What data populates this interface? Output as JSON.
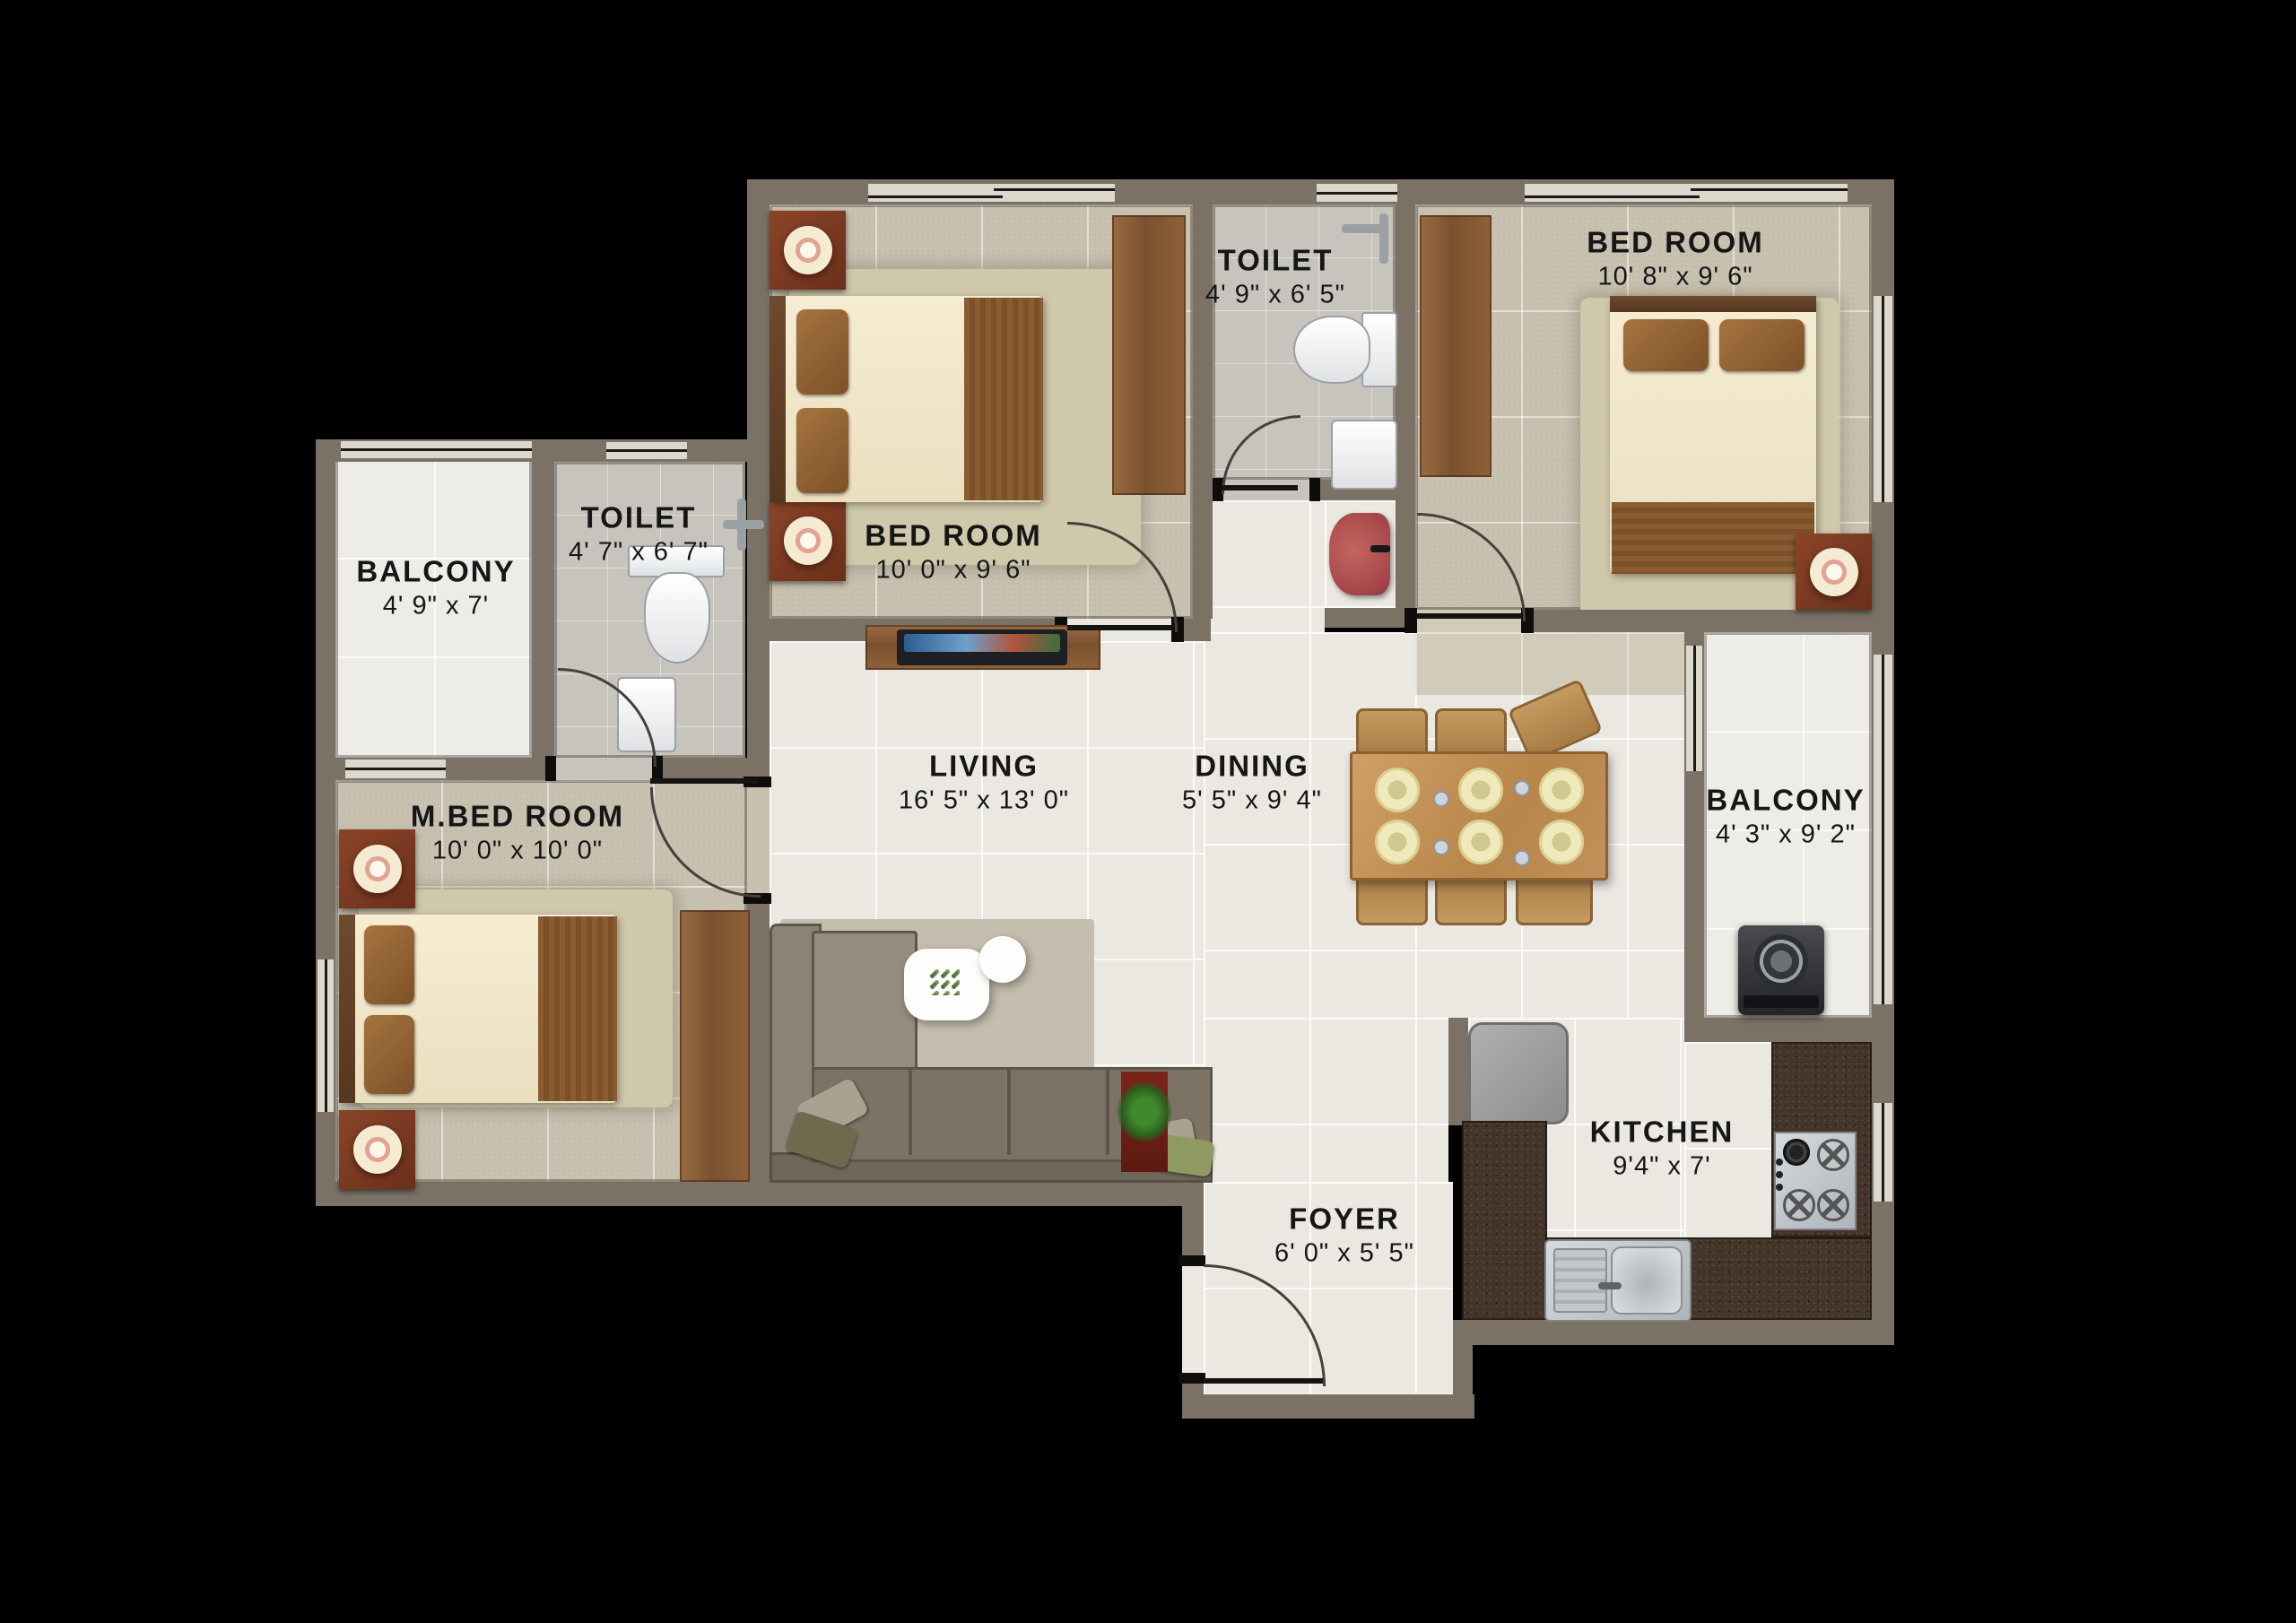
{
  "plan": {
    "background": "#000000",
    "wall_color": "#7b7265",
    "accent_colors": {
      "floor_beige": "#c8c1b0",
      "floor_cream": "#eae8e1",
      "floor_toilet_gray": "#c7c4bd",
      "floor_marble": "#edece6",
      "kitchen_granite": "#43352a",
      "furniture_wood": "#8a5f38",
      "basin_red": "#b35450",
      "label_text": "#161616"
    },
    "rooms": [
      {
        "id": "bedroom-top-left",
        "label": "BED ROOM",
        "dims": "10' 0\" x 9' 6\""
      },
      {
        "id": "toilet-top",
        "label": "TOILET",
        "dims": "4' 9\" x 6' 5\""
      },
      {
        "id": "bedroom-top-right",
        "label": "BED ROOM",
        "dims": "10' 8\" x 9' 6\""
      },
      {
        "id": "balcony-left",
        "label": "BALCONY",
        "dims": "4' 9\" x 7'"
      },
      {
        "id": "toilet-left",
        "label": "TOILET",
        "dims": "4' 7\" x 6' 7\""
      },
      {
        "id": "master-bedroom",
        "label": "M.BED ROOM",
        "dims": "10' 0\" x 10' 0\""
      },
      {
        "id": "living",
        "label": "LIVING",
        "dims": "16' 5\" x 13' 0\""
      },
      {
        "id": "dining",
        "label": "DINING",
        "dims": "5' 5\" x 9' 4\""
      },
      {
        "id": "balcony-right",
        "label": "BALCONY",
        "dims": "4' 3\" x 9' 2\""
      },
      {
        "id": "kitchen",
        "label": "KITCHEN",
        "dims": "9'4\" x 7'"
      },
      {
        "id": "foyer",
        "label": "FOYER",
        "dims": "6' 0\" x 5' 5\""
      }
    ]
  }
}
